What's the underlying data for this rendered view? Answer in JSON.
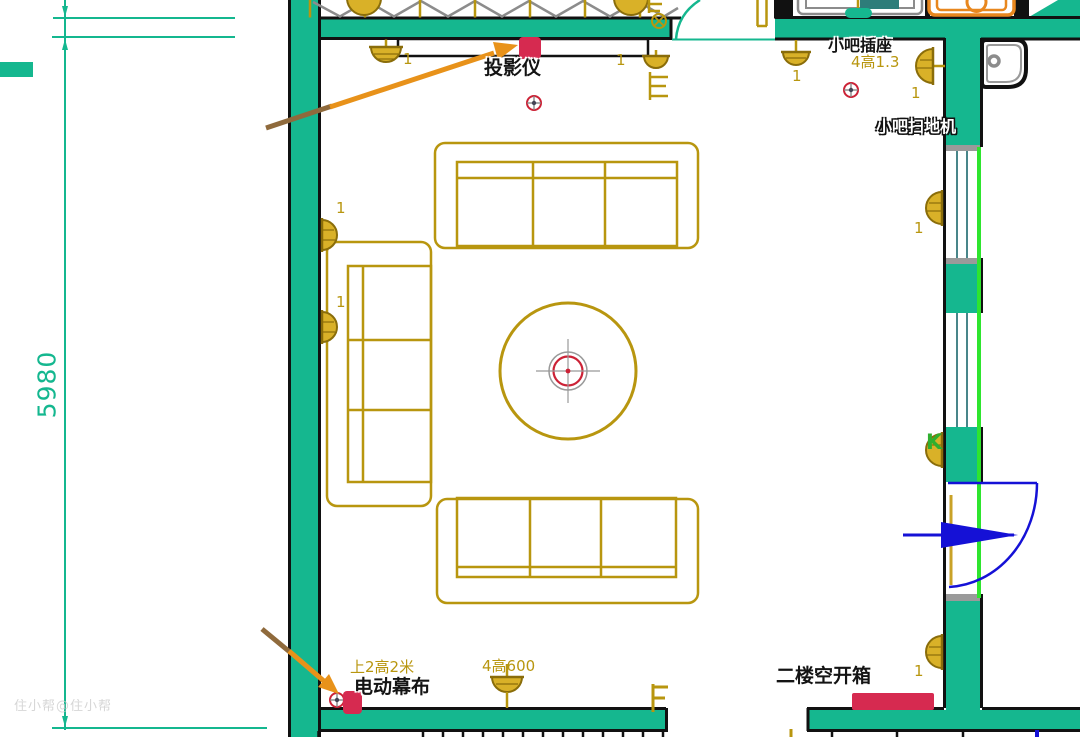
{
  "drawing": {
    "type": "floorplan-lighting-electrical",
    "dimension_left": "5980",
    "watermark": "住小帮@住小帮",
    "annotations": {
      "projector": "投影仪",
      "bar_socket": "小吧插座",
      "bar_socket_spec": "4高1.3",
      "bar_robot_vacuum": "小吧扫地机",
      "screen_spec": "上2高2米",
      "motor_screen": "电动幕布",
      "floor_lamp_spec": "4高600",
      "second_floor_breaker_box": "二楼空开箱",
      "door_lamp_mark": "K",
      "lamp_count": "1"
    },
    "colors": {
      "wall_teal": "#15b78f",
      "symbol_olive": "#b8960f",
      "marker_red": "#d62a50",
      "arrow_orange": "#e8921a",
      "arrow_brown": "#8f6a3c",
      "door_blue": "#1511d6",
      "window_green": "#2ee52e",
      "outline_black": "#111111",
      "truss_gray": "#8c8c8c"
    }
  }
}
